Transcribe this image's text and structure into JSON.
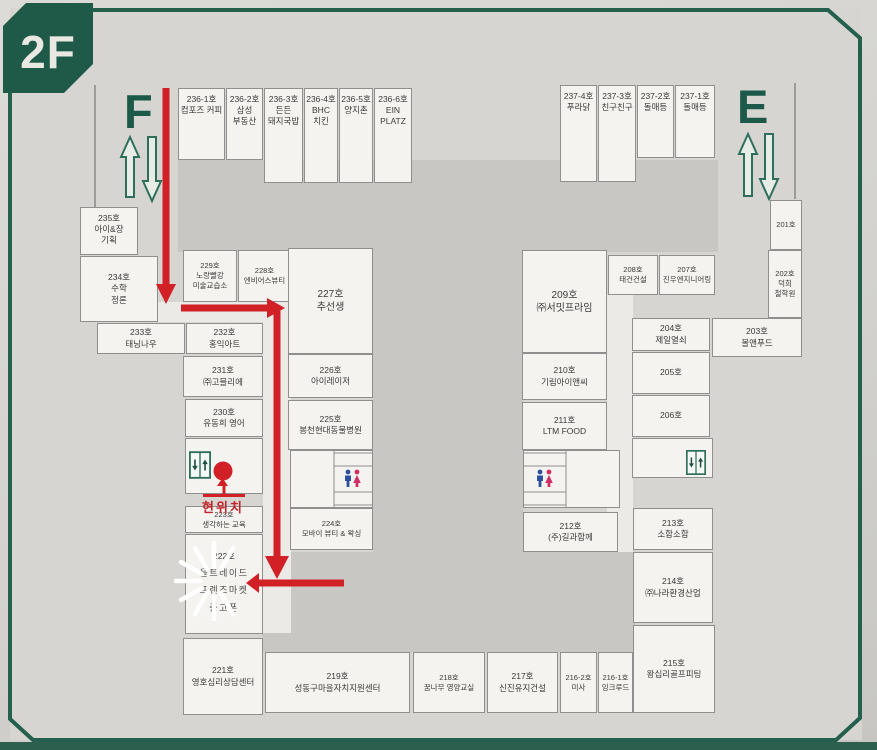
{
  "floor_label": "2F",
  "escalators": {
    "west": "F",
    "east": "E"
  },
  "current_location_label": "현위치",
  "colors": {
    "accent_green": "#1e5a47",
    "route_red": "#d22027",
    "male_icon_blue": "#2b4f9e",
    "female_icon_pink": "#cf2e66"
  },
  "icons": {
    "west_escalator": "up-down-arrow-icons",
    "east_escalator": "up-down-arrow-icons",
    "west_elevator": "elevator-icon",
    "east_elevator": "elevator-icon",
    "west_restroom": "male-female-restroom-icons",
    "east_restroom": "male-female-restroom-icons",
    "current_location_marker": "red-dot-and-up-arrow",
    "highlight": "starburst-around-room-222"
  },
  "rooms": {
    "r236_1": {
      "no": "236-1호",
      "name": "컴포즈 커피"
    },
    "r236_2": {
      "no": "236-2호",
      "name": "삼성\n부동산"
    },
    "r236_3": {
      "no": "236-3호",
      "name": "든든\n돼지국밥"
    },
    "r236_4": {
      "no": "236-4호",
      "name": "BHC\n치킨"
    },
    "r236_5": {
      "no": "236-5호",
      "name": "양지촌"
    },
    "r236_6": {
      "no": "236-6호",
      "name": "EIN\nPLATZ"
    },
    "r237_4": {
      "no": "237-4호",
      "name": "푸라닭"
    },
    "r237_3": {
      "no": "237-3호",
      "name": "친구친구"
    },
    "r237_2": {
      "no": "237-2호",
      "name": "돌매등"
    },
    "r237_1": {
      "no": "237-1호",
      "name": "돌매등"
    },
    "r235": {
      "no": "235호",
      "name": "아이&장\n기획"
    },
    "r234": {
      "no": "234호",
      "name": "수학\n정론"
    },
    "r233": {
      "no": "233호",
      "name": "태닝나우"
    },
    "r232": {
      "no": "232호",
      "name": "홍익아트"
    },
    "r231": {
      "no": "231호",
      "name": "㈜고믈리에"
    },
    "r230": {
      "no": "230호",
      "name": "유동희 영어"
    },
    "r229": {
      "no": "229호",
      "name": "노랑빨강\n미술교습소"
    },
    "r228": {
      "no": "228호",
      "name": "엔비어스뷰티"
    },
    "r227": {
      "no": "227호",
      "name": "추선생"
    },
    "r226": {
      "no": "226호",
      "name": "아이레이저"
    },
    "r225": {
      "no": "225호",
      "name": "봉천현대동물병원"
    },
    "r224": {
      "no": "224호",
      "name": "모바이 뷰티 & 왁싱"
    },
    "r223": {
      "no": "223호",
      "name": "생각하는 교육"
    },
    "r222": {
      "no": "222호",
      "name": "울트레이드\n프렌즈마켓\n중고폰"
    },
    "r221": {
      "no": "221호",
      "name": "영호심리상담센터"
    },
    "r219": {
      "no": "219호",
      "name": "성동구마을자치지원센터"
    },
    "r218": {
      "no": "218호",
      "name": "꿈나무 영양교실"
    },
    "r217": {
      "no": "217호",
      "name": "신진유지건설"
    },
    "r216_2": {
      "no": "216-2호",
      "name": "미사"
    },
    "r216_1": {
      "no": "216-1호",
      "name": "잉크루드"
    },
    "r215": {
      "no": "215호",
      "name": "왕십리골프피팅"
    },
    "r214": {
      "no": "214호",
      "name": "㈜나라환경산업"
    },
    "r213": {
      "no": "213호",
      "name": "소함소함"
    },
    "r212": {
      "no": "212호",
      "name": "(주)길과함께"
    },
    "r211": {
      "no": "211호",
      "name": "LTM FOOD"
    },
    "r210": {
      "no": "210호",
      "name": "기림아이앤씨"
    },
    "r209": {
      "no": "209호",
      "name": "㈜서밋프라임"
    },
    "r208": {
      "no": "208호",
      "name": "태건건설"
    },
    "r207": {
      "no": "207호",
      "name": "진우엔지니어링"
    },
    "r206": {
      "no": "206호",
      "name": ""
    },
    "r205": {
      "no": "205호",
      "name": ""
    },
    "r204": {
      "no": "204호",
      "name": "제일열쇠"
    },
    "r203": {
      "no": "203호",
      "name": "볼앤푸드"
    },
    "r202": {
      "no": "202호",
      "name": "덕희\n철학원"
    },
    "r201": {
      "no": "201호",
      "name": ""
    }
  }
}
